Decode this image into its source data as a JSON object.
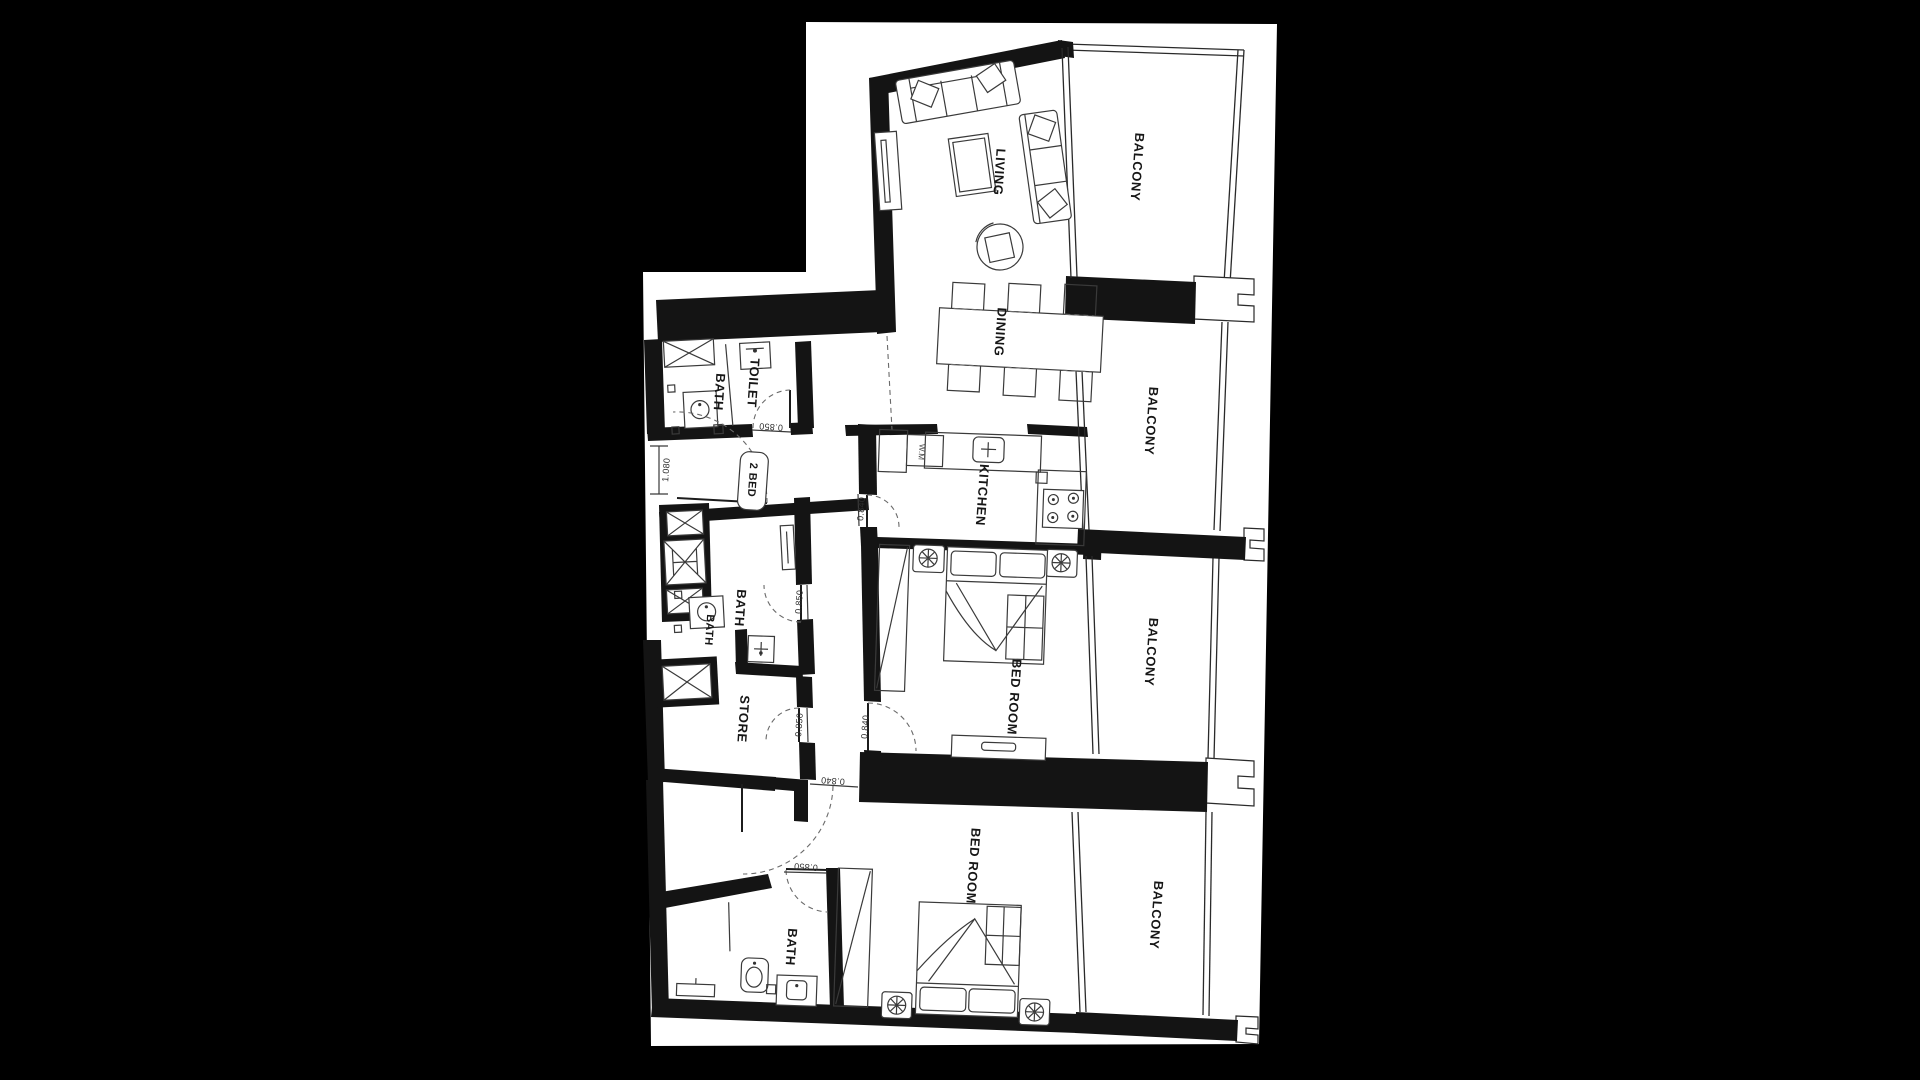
{
  "colors": {
    "background": "#000000",
    "paper": "#ffffff",
    "ink": "#141414",
    "furniture_line": "#3a3a3a",
    "dashed_line": "#6a6a6a"
  },
  "unit": {
    "title": "2 BED"
  },
  "rooms": {
    "living": "LIVING",
    "dining": "DINING",
    "kitchen": "KITCHEN",
    "wm": "W.M",
    "bedroom1": "BED ROOM",
    "bedroom2": "BED ROOM",
    "bath_top": "BATH",
    "toilet": "TOILET",
    "bath_mid": "BATH",
    "bath_mid_small": "BATH",
    "store": "STORE",
    "bath_bottom": "BATH",
    "balcony1": "BALCONY",
    "balcony2": "BALCONY",
    "balcony3": "BALCONY",
    "balcony4": "BALCONY"
  },
  "dimensions": {
    "toilet_door": "0.850",
    "hall_entry": "1.080",
    "bath_mid_door": "0.850",
    "kitchen_door": "0.840",
    "store_door": "0.850",
    "bedroom1_door": "0.840",
    "bedroom2_entry": "0.840",
    "bath_bottom_door": "0.850"
  }
}
